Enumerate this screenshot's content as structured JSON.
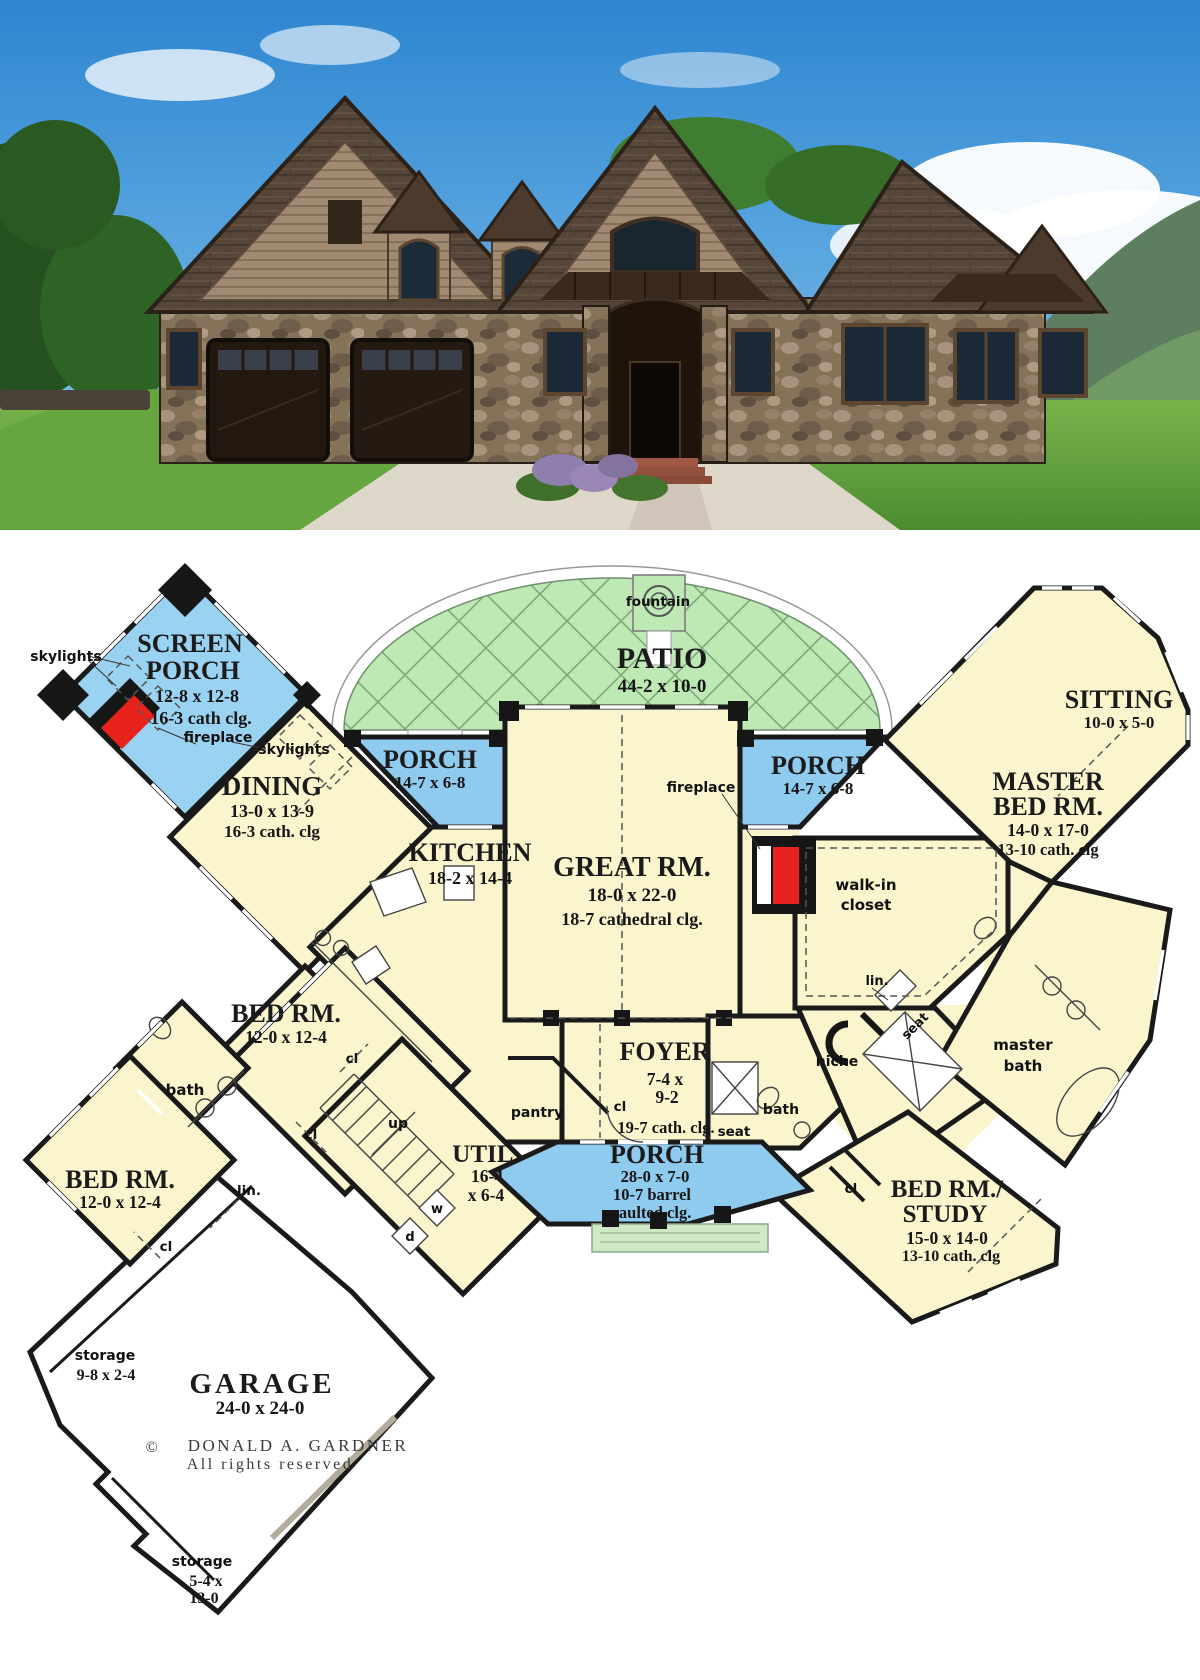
{
  "plan": {
    "screen_porch": {
      "n1": "SCREEN",
      "n2": "PORCH",
      "dim": "12-8 x 12-8",
      "clg": "16-3 cath clg."
    },
    "patio": {
      "name": "PATIO",
      "dim": "44-2 x 10-0",
      "fountain": "fountain"
    },
    "porch_left": {
      "name": "PORCH",
      "dim": "14-7 x 6-8"
    },
    "porch_right": {
      "name": "PORCH",
      "dim": "14-7 x 6-8"
    },
    "porch_front": {
      "name": "PORCH",
      "dim": "28-0 x 7-0",
      "clg1": "10-7 barrel",
      "clg2": "vaulted clg."
    },
    "sitting": {
      "name": "SITTING",
      "dim": "10-0 x 5-0"
    },
    "master_bed": {
      "n1": "MASTER",
      "n2": "BED RM.",
      "dim": "14-0 x 17-0",
      "clg": "13-10 cath. clg"
    },
    "dining": {
      "name": "DINING",
      "dim": "13-0 x 13-9",
      "clg": "16-3 cath. clg"
    },
    "kitchen": {
      "name": "KITCHEN",
      "dim": "18-2 x 14-4"
    },
    "great_room": {
      "name": "GREAT RM.",
      "dim": "18-0 x 22-0",
      "clg": "18-7 cathedral clg."
    },
    "walk_in": {
      "n1": "walk-in",
      "n2": "closet"
    },
    "bed1": {
      "name": "BED RM.",
      "dim": "12-0 x 12-4"
    },
    "bed2": {
      "name": "BED RM.",
      "dim": "12-0 x 12-4"
    },
    "foyer": {
      "name": "FOYER",
      "d1": "7-4 x",
      "d2": "9-2",
      "clg": "19-7 cath. clg."
    },
    "util": {
      "name": "UTIL.",
      "d1": "16-4",
      "d2": "x 6-4"
    },
    "study": {
      "n1": "BED RM./",
      "n2": "STUDY",
      "dim": "15-0 x 14-0",
      "clg": "13-10 cath. clg"
    },
    "master_bath": {
      "n1": "master",
      "n2": "bath"
    },
    "garage": {
      "name": "GARAGE",
      "dim": "24-0 x 24-0"
    },
    "storage1": {
      "name": "storage",
      "dim": "9-8 x 2-4"
    },
    "storage2": {
      "name": "storage",
      "d1": "5-4 x",
      "d2": "13-0"
    },
    "labels": {
      "skylights_left": "skylights",
      "skylights_right": "skylights",
      "fireplace_screen": "fireplace",
      "fireplace_great": "fireplace",
      "bath_left": "bath",
      "bath_right": "bath",
      "pantry": "pantry",
      "up": "up",
      "w": "w",
      "d": "d",
      "lin_left": "lin.",
      "lin_right": "lin.",
      "niche": "niche",
      "seat_diag": "seat",
      "seat_foyer": "seat",
      "cl": "cl"
    },
    "copyright": {
      "sym": "©",
      "l1": "DONALD A. GARDNER",
      "l2": "All rights reserved"
    },
    "colors": {
      "room": "#FAF5CD",
      "porch": "#8FCBEE",
      "patio": "#BEE8B4",
      "fireplace": "#E8231E",
      "wall": "#1A1A1A"
    }
  }
}
